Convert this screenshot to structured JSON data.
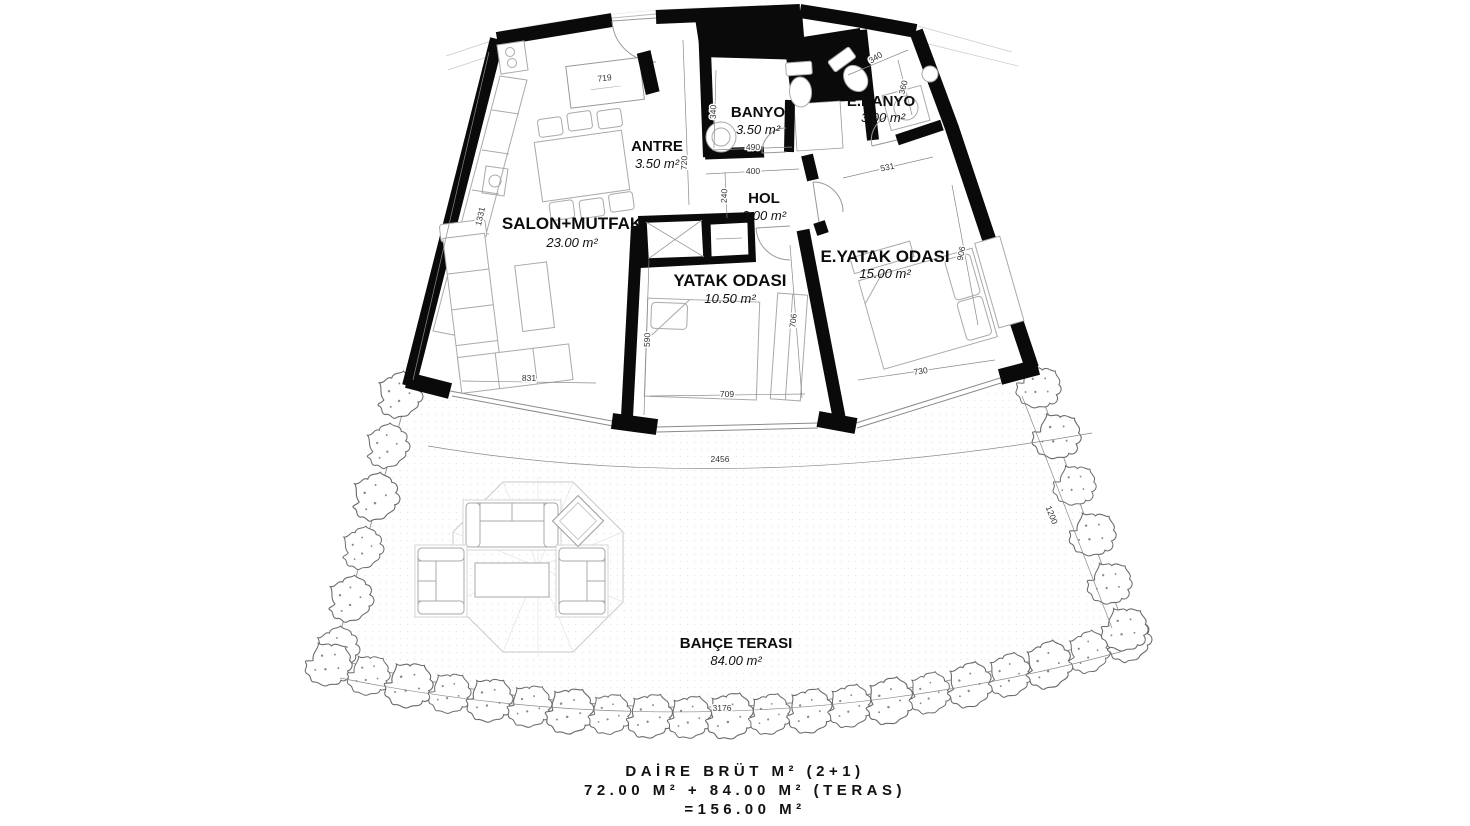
{
  "floorplan": {
    "rooms": [
      {
        "id": "salon",
        "name": "SALON+MUTFAK",
        "area": "23.00 m²"
      },
      {
        "id": "antre",
        "name": "ANTRE",
        "area": "3.50 m²"
      },
      {
        "id": "banyo",
        "name": "BANYO",
        "area": "3.50 m²"
      },
      {
        "id": "ebanyo",
        "name": "E.BANYO",
        "area": "3.00 m²"
      },
      {
        "id": "hol",
        "name": "HOL",
        "area": "3.00 m²"
      },
      {
        "id": "yatak",
        "name": "YATAK ODASI",
        "area": "10.50 m²"
      },
      {
        "id": "eyatak",
        "name": "E.YATAK ODASI",
        "area": "15.00 m²"
      },
      {
        "id": "terrace",
        "name": "BAHÇE TERASI",
        "area": "84.00 m²"
      }
    ],
    "dimensions": {
      "cabinet": "719",
      "salon_left": "1331",
      "antre_height": "720",
      "banyo_width": "340",
      "banyo_door": "490",
      "hol_width": "400",
      "hol_depth": "240",
      "eyatak_top": "531",
      "ebanyo_width": "340",
      "ebanyo_depth": "360",
      "salon_window": "831",
      "yatak_left": "590",
      "yatak_window": "709",
      "yatak_right": "706",
      "eyatak_window": "730",
      "eyatak_right": "906",
      "terrace_top": "2456",
      "terrace_bottom": "3176",
      "terrace_right": "1200"
    },
    "summary": {
      "line1": "DAİRE BRÜT M² (2+1)",
      "line2": "72.00 M² + 84.00 M² (TERAS)",
      "line3": "=156.00 M²"
    },
    "colors": {
      "wall": "#0a0a0a",
      "furniture_line": "#a9a9a9",
      "hedge_line": "#6a6a6a"
    }
  }
}
